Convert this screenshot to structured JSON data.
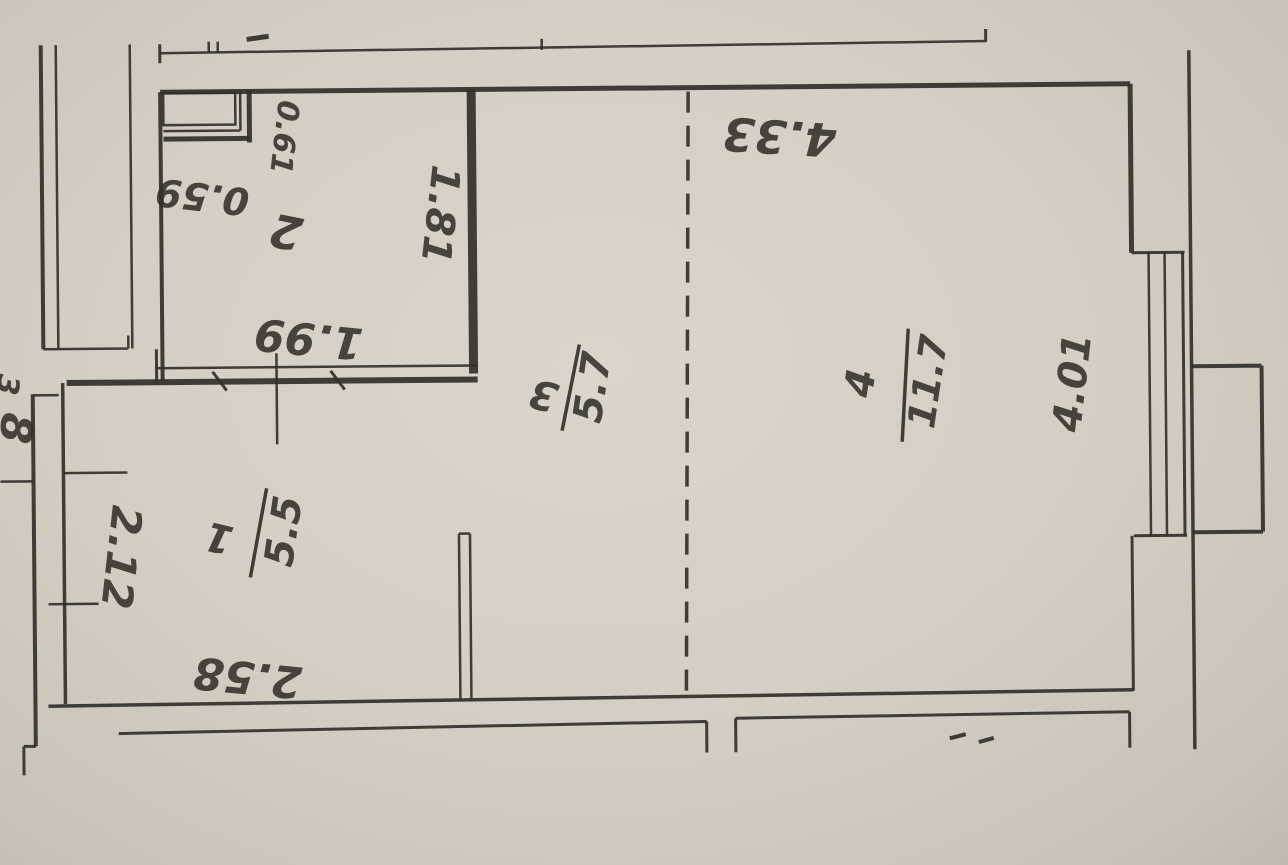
{
  "plan": {
    "title_hint": "apartment floor plan (scanned upside-down)",
    "rooms": [
      {
        "number": "1",
        "area": "5.5"
      },
      {
        "number": "2",
        "area": ""
      },
      {
        "number": "3",
        "area": "5.7"
      },
      {
        "number": "4",
        "area": "11.7"
      }
    ],
    "dimensions": {
      "top_width": "4.33",
      "duct_width": "0.59",
      "duct_depth": "0.61",
      "room2_height": "1.81",
      "room2_width": "1.99",
      "left_wall_segment": "2.12",
      "room1_width": "2.58",
      "room4_wall": "4.01",
      "left_edge_clipped": "8",
      "left_edge_clipped_upper": "3",
      "bottom_clipped": "2.50"
    },
    "colors": {
      "paper": "#d4cec4",
      "ink": "#32302b"
    }
  }
}
